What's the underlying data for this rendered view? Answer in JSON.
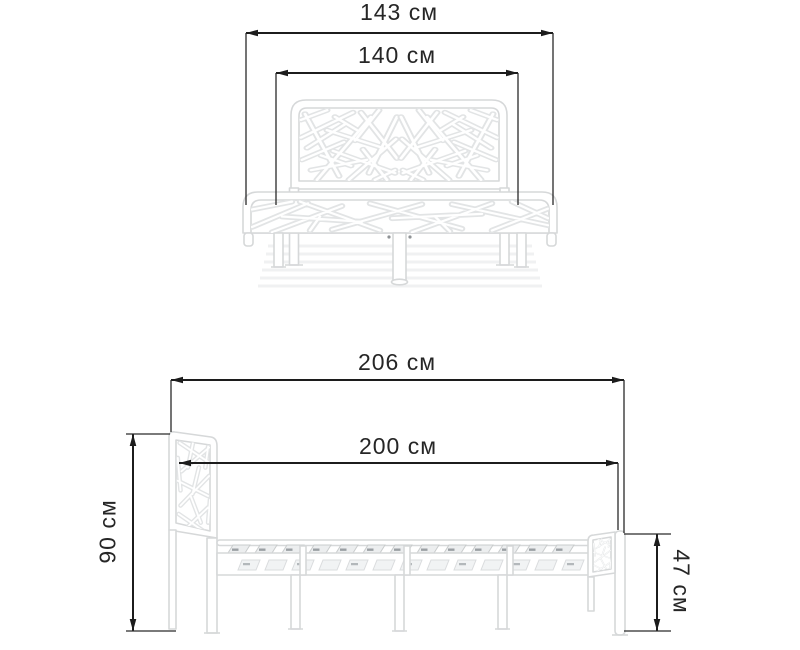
{
  "page": {
    "type": "product-dimensions-diagram",
    "views": [
      "bed-front-view",
      "bed-side-view"
    ]
  },
  "dimensions": {
    "front_view": {
      "overall_width": "143 см",
      "sleeping_width": "140 см"
    },
    "side_view": {
      "overall_length": "206 см",
      "sleeping_length": "200 см",
      "headboard_height": "90 см",
      "frame_height": "47 см"
    }
  },
  "colors": {
    "dimension_line": "#1c1c1c",
    "label_text": "#262626",
    "bed_outline": "#d6d8d9",
    "pattern_stroke": "#e2e4e5",
    "background": "#ffffff"
  }
}
